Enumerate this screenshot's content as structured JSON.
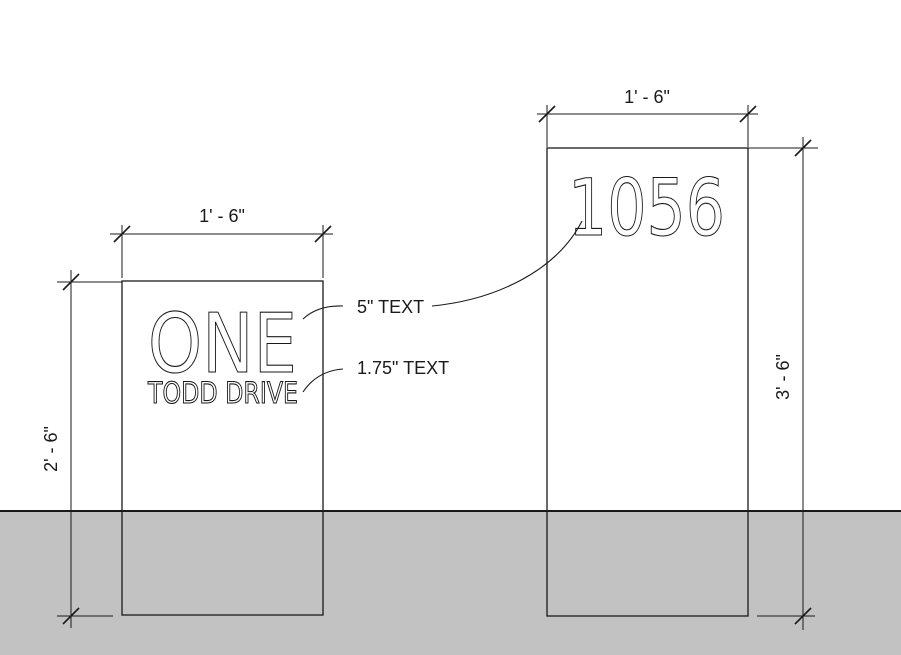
{
  "drawing": {
    "ground_color": "#c2c2c2",
    "line_color": "#1a1a1a",
    "background_color": "#ffffff"
  },
  "left_sign": {
    "line1": "ONE",
    "line2": "TODD DRIVE",
    "width_dim": "1' - 6\"",
    "height_dim": "2' - 6\""
  },
  "right_sign": {
    "number": "1056",
    "width_dim": "1' - 6\"",
    "height_dim": "3' - 6\""
  },
  "annotations": {
    "large_text_label": "5\" TEXT",
    "small_text_label": "1.75\" TEXT"
  }
}
